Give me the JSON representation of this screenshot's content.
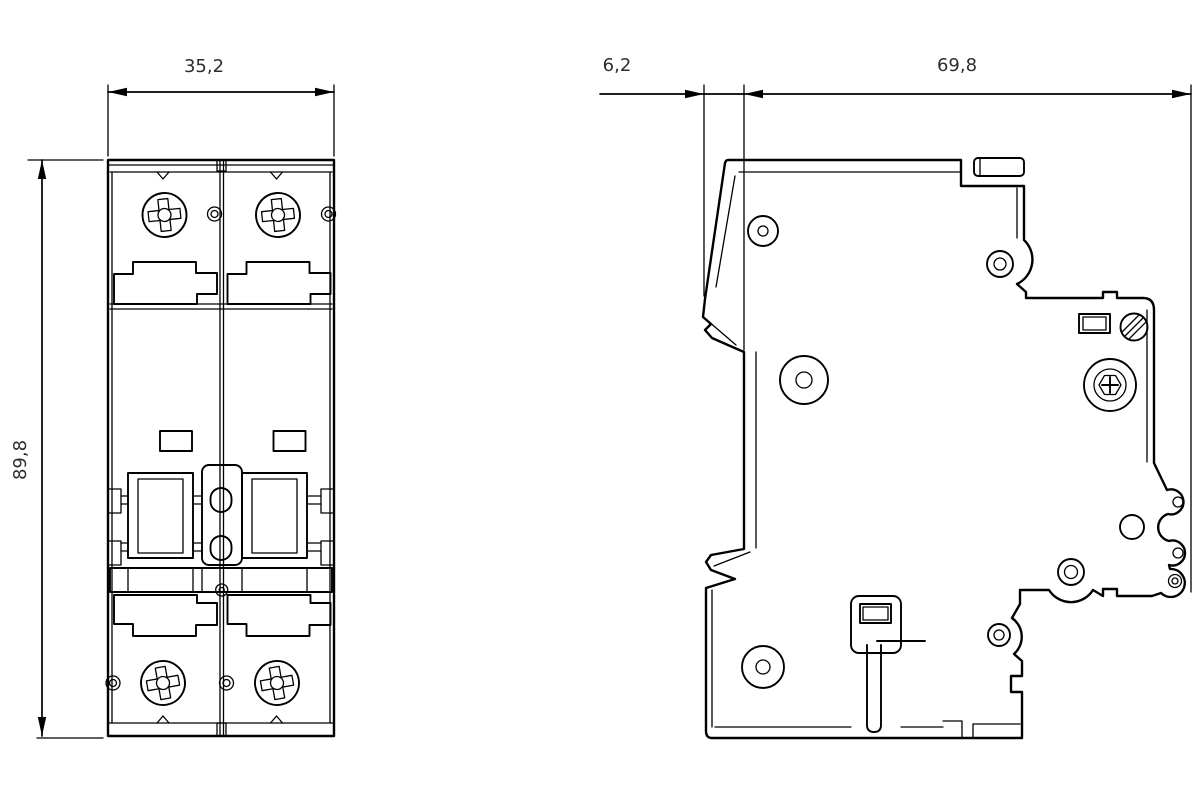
{
  "colors": {
    "background": "#ffffff",
    "line": "#000000",
    "dimension_text": "#2e2e2e"
  },
  "dimensions": {
    "front_width": "35,2",
    "front_height": "89,8",
    "side_rail_offset": "6,2",
    "side_depth": "69,8"
  }
}
